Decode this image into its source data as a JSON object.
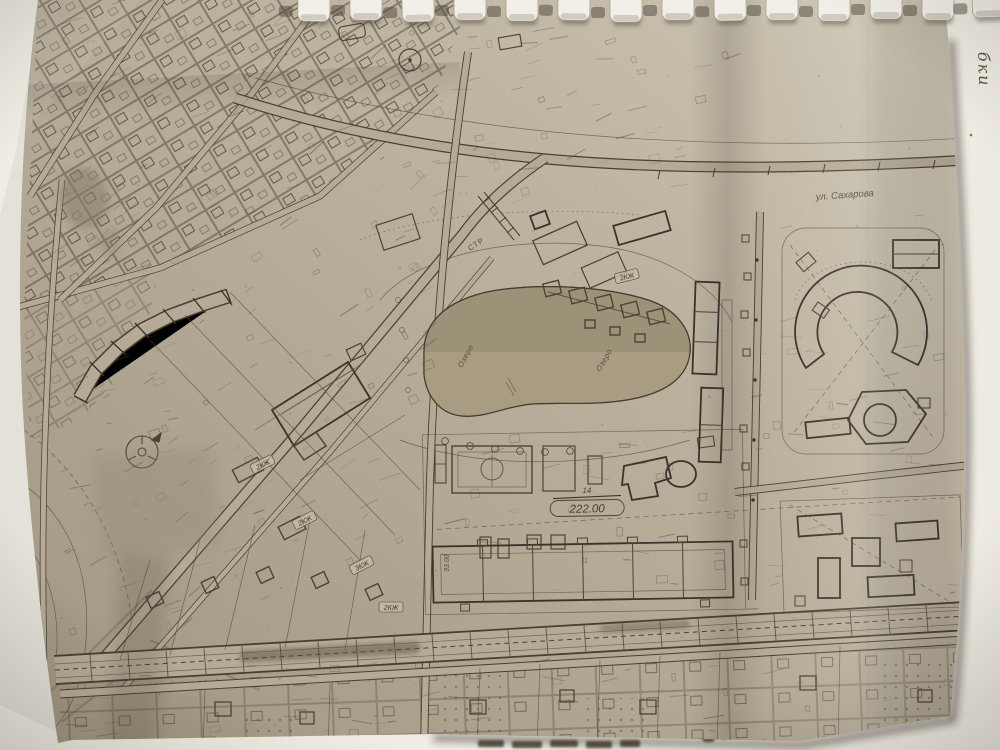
{
  "photo": {
    "description": "photograph of a comb-bound paper town-plan (genplan) sheet",
    "colors": {
      "backdrop": "#e4e1d8",
      "backing_page": "#efece4",
      "paper_light": "#cdc6b4",
      "paper_mid": "#b4aa97",
      "paper_dark": "#a09681",
      "pond_fill": "#a89d82",
      "ink": "#4c4336",
      "ink_bold": "#3a332a",
      "comb_plastic": "#f2efe8",
      "shadow": "#4a443c"
    },
    "labels": {
      "street_top": "ул. Сахарова",
      "dim_mark": "14",
      "dim_value": "222.00",
      "pond_a": "Озеро",
      "pond_b": "Озеро",
      "construction": "СТР",
      "elevation_vertical": "33.00",
      "handwritten_margin": "бки",
      "buildings": [
        "2КЖ",
        "2КЖ",
        "3КЖ",
        "2КЖ",
        "2КЖ"
      ]
    }
  }
}
